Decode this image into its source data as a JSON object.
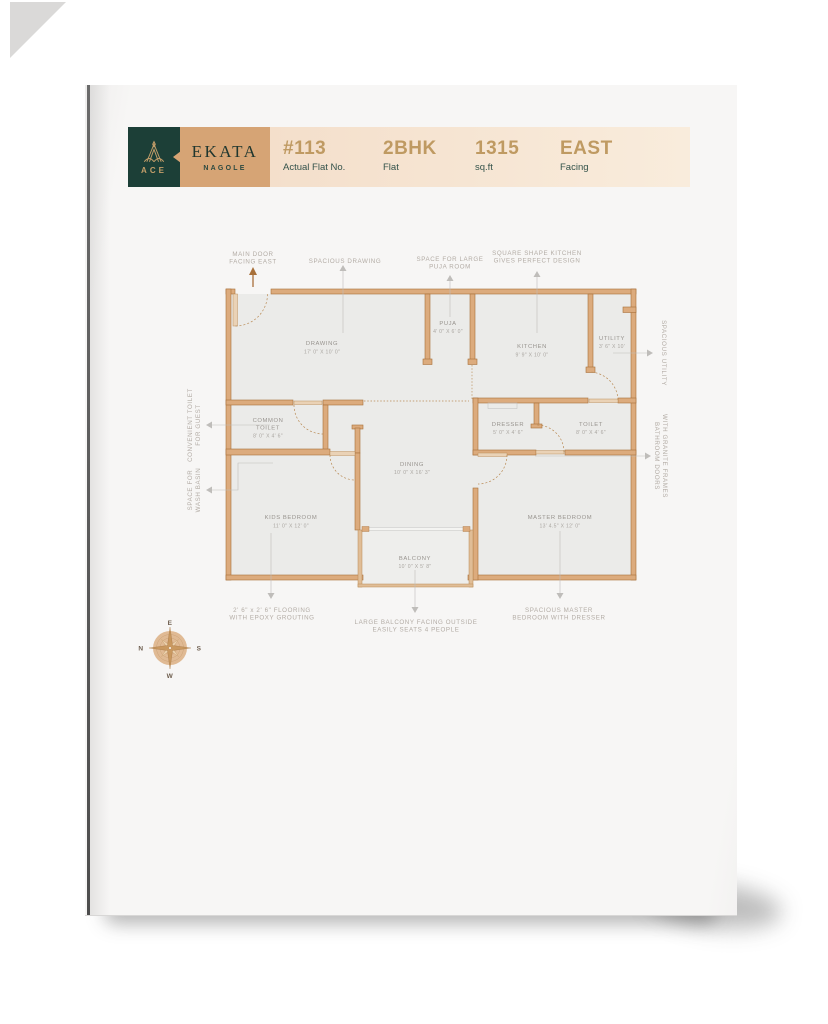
{
  "header": {
    "brand": "ACE",
    "project_name": "EKATA",
    "project_location": "NAGOLE",
    "stats": [
      {
        "value": "#113",
        "label": "Actual Flat No."
      },
      {
        "value": "2BHK",
        "label": "Flat"
      },
      {
        "value": "1315",
        "label": "sq.ft"
      },
      {
        "value": "EAST",
        "label": "Facing"
      }
    ]
  },
  "plan": {
    "rooms": {
      "drawing": {
        "name": "DRAWING",
        "dim": "17' 0\" X 10' 0\""
      },
      "puja": {
        "name": "PUJA",
        "dim": "4' 0\" X 6' 0\""
      },
      "kitchen": {
        "name": "KITCHEN",
        "dim": "9' 9\" X 10' 0\""
      },
      "utility": {
        "name": "UTILITY",
        "dim": "3' 6\" X 10'"
      },
      "common_toilet": {
        "name1": "COMMON",
        "name2": "TOILET",
        "dim": "8' 0\" X 4' 6\""
      },
      "dresser": {
        "name": "DRESSER",
        "dim": "5' 0\" X 4' 6\""
      },
      "toilet": {
        "name": "TOILET",
        "dim": "8' 0\" X 4' 6\""
      },
      "dining": {
        "name": "DINING",
        "dim": "10' 0\" X 16' 3\""
      },
      "kids_bedroom": {
        "name": "KIDS BEDROOM",
        "dim": "11' 0\" X 12' 0\""
      },
      "master_bedroom": {
        "name": "MASTER BEDROOM",
        "dim": "13' 4.5\" X 12' 0\""
      },
      "balcony": {
        "name": "BALCONY",
        "dim": "10' 0\" X 5' 8\""
      }
    },
    "annotations": {
      "main_door": [
        "MAIN DOOR",
        "FACING EAST"
      ],
      "spacious_drawing": [
        "SPACIOUS DRAWING"
      ],
      "puja_room": [
        "SPACE FOR LARGE",
        "PUJA ROOM"
      ],
      "kitchen_note": [
        "SQUARE SHAPE KITCHEN",
        "GIVES PERFECT DESIGN"
      ],
      "guest_toilet": [
        "CONVENIENT TOILET",
        "FOR GUEST"
      ],
      "wash_basin": [
        "SPACE FOR",
        "WASH BASIN"
      ],
      "utility_note": [
        "SPACIOUS UTILITY"
      ],
      "bathroom_doors": [
        "BATHROOM DOORS",
        "WITH GRANITE FRAMES"
      ],
      "flooring": [
        "2' 6\" x 2' 6\" FLOORING",
        "WITH EPOXY GROUTING"
      ],
      "balcony_note": [
        "LARGE BALCONY FACING OUTSIDE",
        "EASILY SEATS 4 PEOPLE"
      ],
      "master_note": [
        "SPACIOUS MASTER",
        "BEDROOM WITH DRESSER"
      ]
    },
    "compass": {
      "e": "E",
      "n": "N",
      "s": "S",
      "w": "W"
    }
  },
  "colors": {
    "brand_green": "#1c3f37",
    "gold": "#bf9a62",
    "wall_fill": "#dcab7d",
    "wall_line": "#a8703a",
    "cream": "#f6e3d1"
  }
}
